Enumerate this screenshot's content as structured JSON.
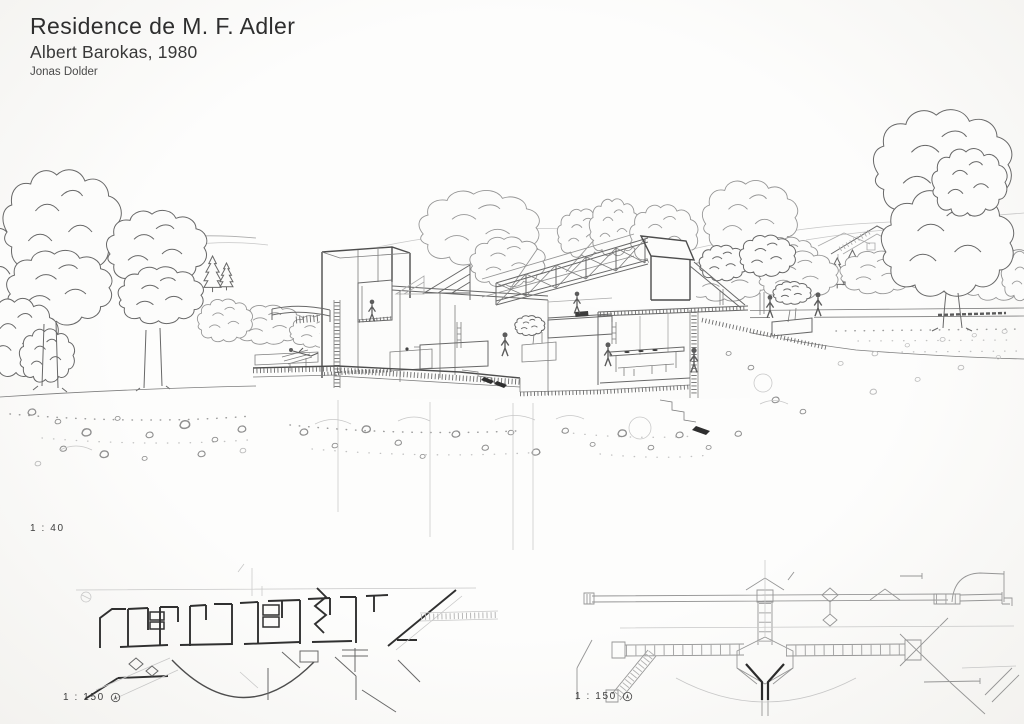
{
  "palette": {
    "paper": "#fcfcfb",
    "ink": "#5f5f5f",
    "dark_ink": "#2e2e2e",
    "faint_ink": "#ababab"
  },
  "header": {
    "title": "Residence de M. F. Adler",
    "architect_year": "Albert Barokas, 1980",
    "author": "Jonas Dolder"
  },
  "perspective": {
    "scale_label": "1 : 40"
  },
  "floor_plan": {
    "scale_label": "1 : 150",
    "north_icon": "north-arrow-circle-icon"
  },
  "roof_plan": {
    "scale_label": "1 : 150",
    "north_icon": "north-arrow-circle-icon"
  }
}
